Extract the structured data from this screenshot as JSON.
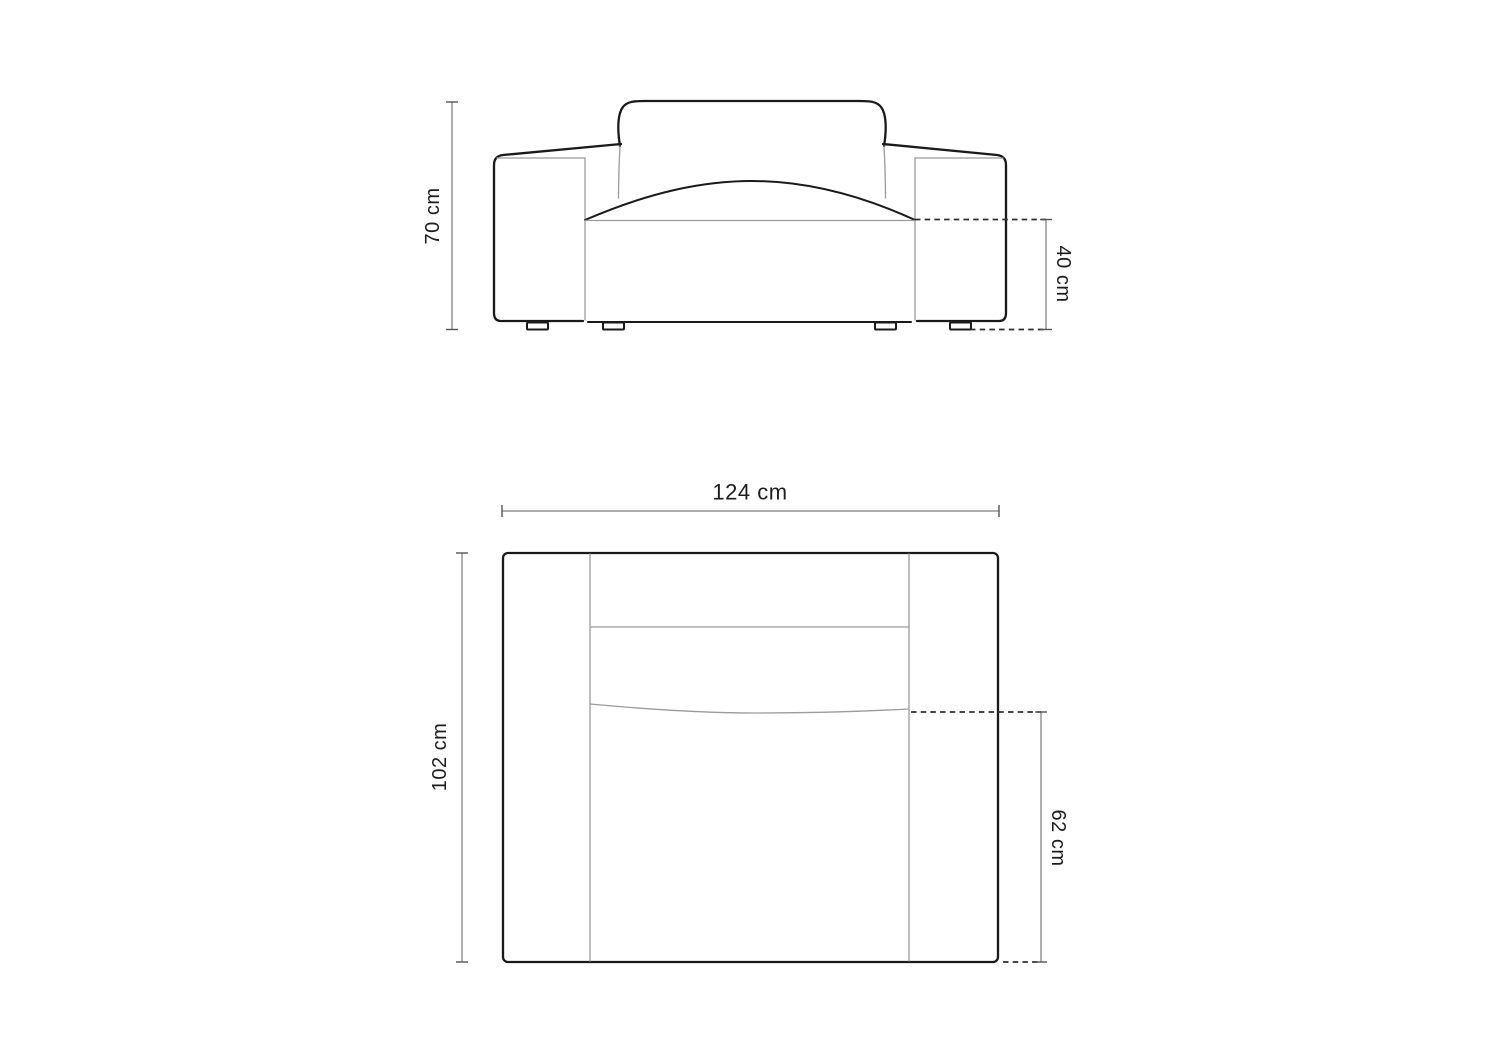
{
  "dimensions": {
    "front_height": "70 cm",
    "front_seat_height": "40 cm",
    "top_width": "124 cm",
    "top_depth": "102 cm",
    "top_seat_depth": "62 cm"
  },
  "colors": {
    "background": "#ffffff",
    "outline": "#1a1a1a",
    "detail_line": "#9b9b9b",
    "dimension_line": "#7a7a7a",
    "dashed_line": "#2f2f2f",
    "text": "#1d1d1d"
  }
}
